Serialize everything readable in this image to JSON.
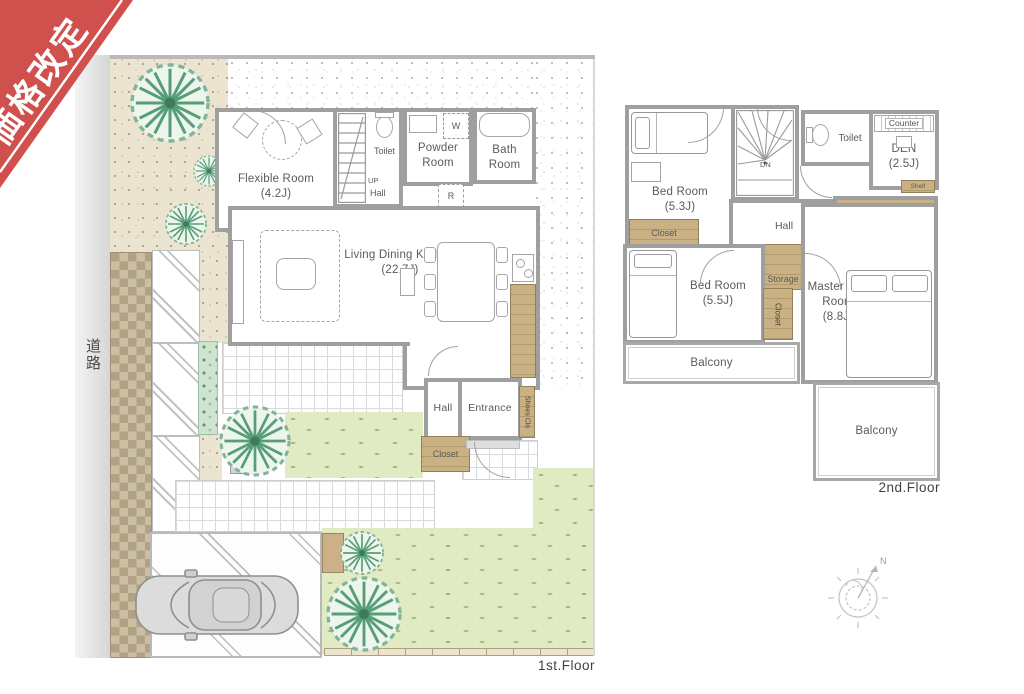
{
  "ribbon": {
    "label": "価格改定"
  },
  "road": {
    "label": "道路"
  },
  "compass": {
    "north_label": "N"
  },
  "floor1": {
    "caption": "1st.Floor",
    "rooms": {
      "flexible": {
        "name": "Flexible Room",
        "size": "(4.2J)"
      },
      "stairs": {
        "up_label": "UP"
      },
      "hall_upper": {
        "name": "Hall"
      },
      "toilet": {
        "name": "Toilet"
      },
      "powder": {
        "name": "Powder Room"
      },
      "washer": {
        "name": "W"
      },
      "bath": {
        "name": "Bath Room"
      },
      "fridge": {
        "name": "R"
      },
      "ldk": {
        "name": "Living Dining Kitchen",
        "size": "(22.7J)"
      },
      "hall": {
        "name": "Hall"
      },
      "entrance": {
        "name": "Entrance"
      },
      "shoes_closet": {
        "name": "Shoes Clo"
      },
      "closet": {
        "name": "Closet"
      }
    }
  },
  "floor2": {
    "caption": "2nd.Floor",
    "rooms": {
      "bedroom1": {
        "name": "Bed Room",
        "size": "(5.3J)"
      },
      "stairs": {
        "down_label": "DN"
      },
      "toilet": {
        "name": "Toilet"
      },
      "counter": {
        "name": "Counter"
      },
      "den": {
        "name": "DEN",
        "size": "(2.5J)"
      },
      "shelf": {
        "name": "Shelf"
      },
      "closet1": {
        "name": "Closet"
      },
      "hall": {
        "name": "Hall"
      },
      "wic": {
        "name": "W.I.C"
      },
      "storage": {
        "name": "Storage"
      },
      "bedroom2": {
        "name": "Bed Room",
        "size": "(5.5J)"
      },
      "closet2": {
        "name": "Closet"
      },
      "master": {
        "name": "Master Bed Room",
        "size": "(8.8J)"
      },
      "balcony_left": {
        "name": "Balcony"
      },
      "balcony_right": {
        "name": "Balcony"
      }
    }
  },
  "colors": {
    "ribbon-red": "#d0504d",
    "wall-gray": "#9f9f9f",
    "closet-tan": "#c9b183",
    "lawn-green": "#e0eac3",
    "hedge-green": "#7db394",
    "beige-gravel": "#ebe4d1"
  }
}
